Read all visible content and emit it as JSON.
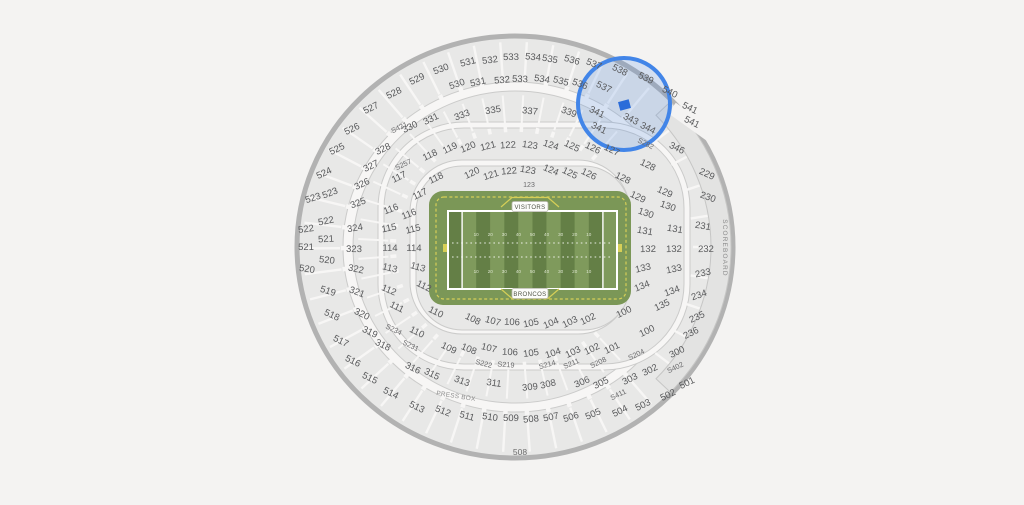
{
  "page": {
    "background": "#f4f3f2"
  },
  "colors": {
    "section_fill": "#e8e8e7",
    "walkway": "#f7f6f5",
    "outer_stroke": "#b2b2b2",
    "ring_stroke": "#cbcbca",
    "field_green": "#7b9757",
    "stripe_dark": "#647f46",
    "stripe_light": "#7f9a5c",
    "yard_yellow": "#d6cf57",
    "highlight_blue": "#4285e8",
    "marker_blue": "#2b6cd9"
  },
  "map": {
    "field": {
      "visitor_label": "VISITORS",
      "home_label": "BRONCOS",
      "yard_numbers": [
        "10",
        "20",
        "30",
        "40",
        "50",
        "40",
        "30",
        "20",
        "10"
      ]
    },
    "scoreboard_label": "SCOREBOARD",
    "press_box_label": "PRESS BOX",
    "bottom_gate_label": "508",
    "selection": {
      "circle": {
        "x": 624,
        "y": 104,
        "r": 46
      },
      "marker": {
        "x": 624.5,
        "y": 105,
        "w": 11,
        "h": 9,
        "rotate": -15
      }
    },
    "tunnel_labels": [
      [
        "123",
        529,
        187
      ]
    ],
    "sections": [
      [
        "529",
        417,
        79
      ],
      [
        "530",
        441,
        69
      ],
      [
        "531",
        468,
        62
      ],
      [
        "532",
        490,
        60
      ],
      [
        "533",
        511,
        57
      ],
      [
        "534",
        533,
        57
      ],
      [
        "535",
        550,
        59
      ],
      [
        "536",
        572,
        60
      ],
      [
        "537",
        594,
        64
      ],
      [
        "538",
        620,
        70
      ],
      [
        "539",
        646,
        78
      ],
      [
        "540",
        670,
        92
      ],
      [
        "541",
        690,
        108
      ],
      [
        "541",
        692,
        122
      ],
      [
        "528",
        394,
        93
      ],
      [
        "527",
        371,
        108
      ],
      [
        "526",
        352,
        129
      ],
      [
        "525",
        337,
        149
      ],
      [
        "524",
        324,
        173
      ],
      [
        "523",
        313,
        198
      ],
      [
        "522",
        306,
        229
      ],
      [
        "521",
        306,
        247
      ],
      [
        "520",
        307,
        269
      ],
      [
        "519",
        328,
        291
      ],
      [
        "518",
        332,
        315
      ],
      [
        "517",
        341,
        341
      ],
      [
        "516",
        353,
        361
      ],
      [
        "515",
        370,
        378
      ],
      [
        "514",
        391,
        393
      ],
      [
        "513",
        417,
        407
      ],
      [
        "512",
        443,
        411
      ],
      [
        "511",
        467,
        416
      ],
      [
        "510",
        490,
        417
      ],
      [
        "509",
        511,
        418
      ],
      [
        "508",
        531,
        419
      ],
      [
        "507",
        551,
        417
      ],
      [
        "506",
        571,
        417
      ],
      [
        "505",
        593,
        414
      ],
      [
        "504",
        620,
        411
      ],
      [
        "503",
        643,
        405
      ],
      [
        "502",
        668,
        395
      ],
      [
        "501",
        687,
        383
      ],
      [
        "530",
        457,
        84
      ],
      [
        "531",
        478,
        82
      ],
      [
        "532",
        502,
        80
      ],
      [
        "533",
        520,
        79
      ],
      [
        "534",
        542,
        79
      ],
      [
        "535",
        561,
        81
      ],
      [
        "536",
        580,
        84
      ],
      [
        "537",
        604,
        87
      ],
      [
        "523",
        330,
        193
      ],
      [
        "522",
        326,
        221
      ],
      [
        "521",
        326,
        239
      ],
      [
        "520",
        327,
        260
      ],
      [
        "330",
        410,
        127
      ],
      [
        "331",
        431,
        119
      ],
      [
        "333",
        462,
        115
      ],
      [
        "335",
        493,
        110
      ],
      [
        "337",
        530,
        111
      ],
      [
        "339",
        569,
        112
      ],
      [
        "341",
        597,
        112
      ],
      [
        "343",
        631,
        119
      ],
      [
        "341",
        599,
        128
      ],
      [
        "344",
        648,
        128
      ],
      [
        "346",
        677,
        148
      ],
      [
        "328",
        383,
        149
      ],
      [
        "327",
        371,
        166
      ],
      [
        "326",
        362,
        184
      ],
      [
        "325",
        358,
        203
      ],
      [
        "324",
        355,
        228
      ],
      [
        "323",
        354,
        249
      ],
      [
        "322",
        356,
        269
      ],
      [
        "321",
        357,
        292
      ],
      [
        "320",
        362,
        314
      ],
      [
        "319",
        370,
        332
      ],
      [
        "318",
        383,
        345
      ],
      [
        "316",
        413,
        368
      ],
      [
        "315",
        432,
        374
      ],
      [
        "313",
        462,
        381
      ],
      [
        "311",
        494,
        383
      ],
      [
        "309",
        530,
        387
      ],
      [
        "308",
        548,
        384
      ],
      [
        "306",
        582,
        382
      ],
      [
        "305",
        601,
        383
      ],
      [
        "303",
        630,
        379
      ],
      [
        "302",
        650,
        370
      ],
      [
        "300",
        677,
        352
      ],
      [
        "S421",
        399,
        127
      ],
      [
        "S282",
        646,
        143
      ],
      [
        "S257",
        403,
        164
      ],
      [
        "S234",
        394,
        329
      ],
      [
        "S231",
        411,
        345
      ],
      [
        "S222",
        484,
        363
      ],
      [
        "S219",
        506,
        364
      ],
      [
        "S214",
        547,
        364
      ],
      [
        "S211",
        571,
        363
      ],
      [
        "S208",
        598,
        362
      ],
      [
        "S204",
        636,
        354
      ],
      [
        "S402",
        675,
        367
      ],
      [
        "S411",
        618,
        394
      ],
      [
        "229",
        707,
        174
      ],
      [
        "230",
        708,
        197
      ],
      [
        "231",
        703,
        226
      ],
      [
        "232",
        706,
        249
      ],
      [
        "233",
        703,
        273
      ],
      [
        "234",
        699,
        295
      ],
      [
        "235",
        697,
        317
      ],
      [
        "236",
        691,
        333
      ],
      [
        "118",
        430,
        155
      ],
      [
        "119",
        450,
        148
      ],
      [
        "120",
        468,
        147
      ],
      [
        "121",
        488,
        146
      ],
      [
        "122",
        508,
        145
      ],
      [
        "123",
        530,
        145
      ],
      [
        "124",
        551,
        145
      ],
      [
        "125",
        572,
        146
      ],
      [
        "126",
        593,
        148
      ],
      [
        "127",
        612,
        150
      ],
      [
        "118",
        436,
        178
      ],
      [
        "120",
        472,
        173
      ],
      [
        "121",
        491,
        175
      ],
      [
        "122",
        509,
        171
      ],
      [
        "123",
        528,
        170
      ],
      [
        "124",
        551,
        170
      ],
      [
        "125",
        570,
        173
      ],
      [
        "126",
        589,
        174
      ],
      [
        "128",
        623,
        178
      ],
      [
        "117",
        399,
        177
      ],
      [
        "117",
        420,
        194
      ],
      [
        "116",
        391,
        209
      ],
      [
        "116",
        409,
        214
      ],
      [
        "115",
        389,
        228
      ],
      [
        "115",
        413,
        229
      ],
      [
        "114",
        390,
        248
      ],
      [
        "114",
        414,
        248
      ],
      [
        "113",
        390,
        268
      ],
      [
        "113",
        418,
        267
      ],
      [
        "112",
        389,
        290
      ],
      [
        "112",
        424,
        286
      ],
      [
        "111",
        397,
        307
      ],
      [
        "110",
        417,
        332
      ],
      [
        "110",
        436,
        312
      ],
      [
        "109",
        449,
        348
      ],
      [
        "108",
        469,
        349
      ],
      [
        "107",
        489,
        348
      ],
      [
        "106",
        510,
        352
      ],
      [
        "105",
        531,
        353
      ],
      [
        "104",
        553,
        353
      ],
      [
        "103",
        573,
        352
      ],
      [
        "102",
        592,
        349
      ],
      [
        "101",
        612,
        348
      ],
      [
        "108",
        473,
        319
      ],
      [
        "107",
        493,
        321
      ],
      [
        "106",
        512,
        322
      ],
      [
        "105",
        531,
        323
      ],
      [
        "104",
        551,
        323
      ],
      [
        "103",
        570,
        322
      ],
      [
        "102",
        588,
        319
      ],
      [
        "100",
        624,
        312
      ],
      [
        "100",
        647,
        331
      ],
      [
        "128",
        648,
        165
      ],
      [
        "129",
        665,
        192
      ],
      [
        "129",
        638,
        197
      ],
      [
        "130",
        668,
        206
      ],
      [
        "130",
        646,
        213
      ],
      [
        "131",
        675,
        229
      ],
      [
        "131",
        645,
        231
      ],
      [
        "132",
        674,
        249
      ],
      [
        "132",
        648,
        249
      ],
      [
        "133",
        674,
        269
      ],
      [
        "133",
        643,
        268
      ],
      [
        "134",
        672,
        291
      ],
      [
        "134",
        642,
        286
      ],
      [
        "135",
        662,
        305
      ]
    ]
  }
}
